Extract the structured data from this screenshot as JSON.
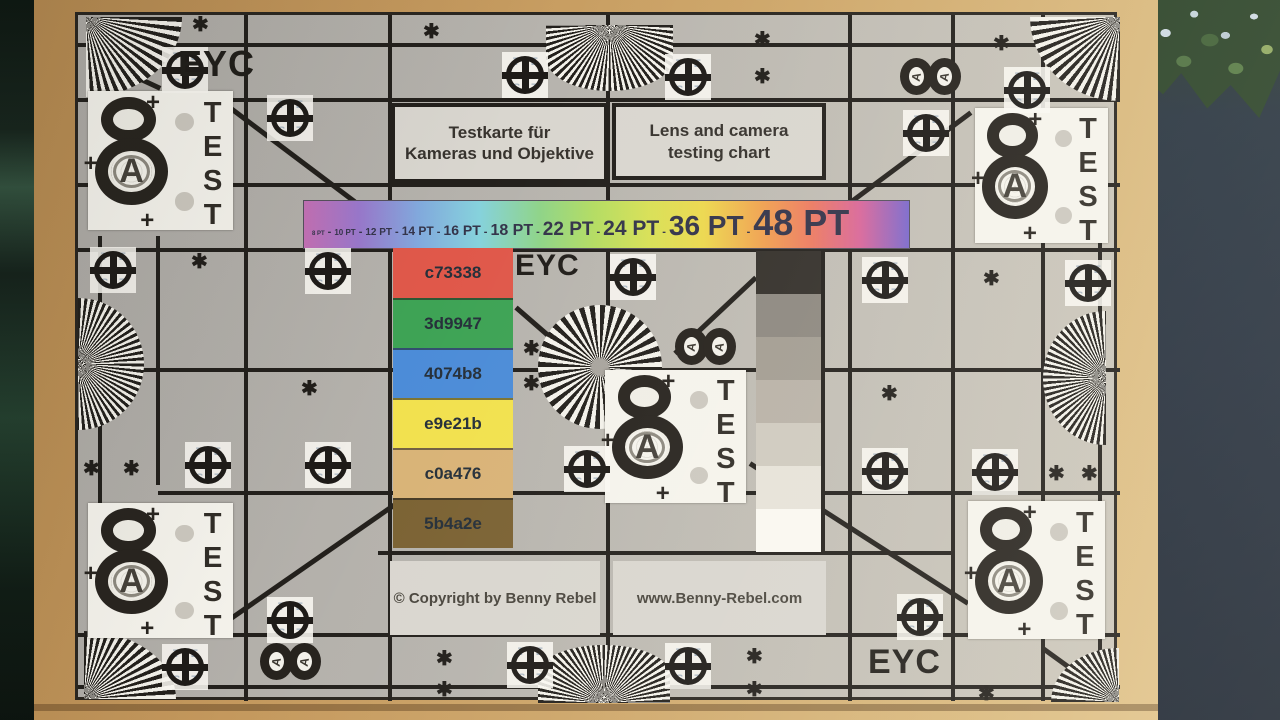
{
  "palette": {
    "cardboard": "#cda568",
    "dark_left": "#17251d",
    "dark_right": "#232d3b",
    "foliage": "#2a4227",
    "chart_bg": "#b6b3ad",
    "grid_line": "#23201c",
    "rainbow": [
      "#c470b4",
      "#9a78cc",
      "#82aade",
      "#86d2dc",
      "#8fd488",
      "#b4dc62",
      "#d8e056",
      "#ecd84e",
      "#f0a050",
      "#ec7a62",
      "#d8669a",
      "#7a68cc"
    ]
  },
  "chart": {
    "eyc_labels": [
      "EYC",
      "EYC",
      "EYC"
    ],
    "title_de": [
      "Testkarte für",
      "Kameras und Objektive"
    ],
    "title_en": [
      "Lens and camera",
      "testing chart"
    ],
    "scale": {
      "labels": [
        "8 PT",
        "10 PT",
        "12 PT",
        "14 PT",
        "16 PT",
        "18 PT",
        "22 PT",
        "24 PT",
        "36 PT",
        "48 PT"
      ],
      "sep": "-"
    },
    "color_patches": [
      {
        "label": "c73338",
        "color": "#e0584a"
      },
      {
        "label": "3d9947",
        "color": "#3ea355"
      },
      {
        "label": "4074b8",
        "color": "#4c8cd8"
      },
      {
        "label": "e9e21b",
        "color": "#f2e14e"
      },
      {
        "label": "c0a476",
        "color": "#d9b377"
      },
      {
        "label": "5b4a2e",
        "color": "#7b6233"
      }
    ],
    "grayscale_steps": [
      "#34302b",
      "#8d8880",
      "#a39d92",
      "#b9b2a7",
      "#cfcabf",
      "#e6e2d9",
      "#faf8f1"
    ],
    "copyright": "© Copyright by Benny Rebel",
    "website": "www.Benny-Rebel.com",
    "marks": {
      "test": "TEST",
      "a": "A",
      "asterisk": "✱",
      "plus": "+",
      "crosshair_top": "TE",
      "crosshair_bottom": "ST"
    }
  }
}
